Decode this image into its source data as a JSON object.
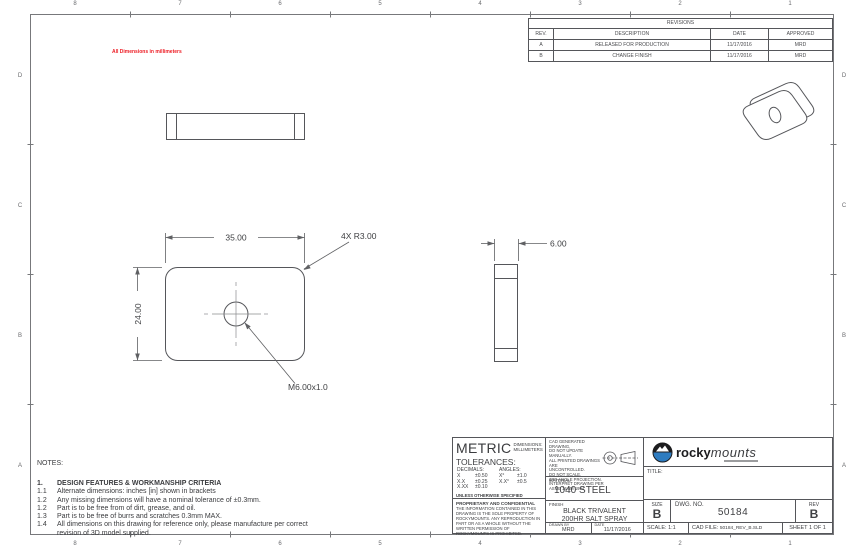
{
  "sheet": {
    "columns": [
      "8",
      "7",
      "6",
      "5",
      "4",
      "3",
      "2",
      "1"
    ],
    "rows": [
      "D",
      "C",
      "B",
      "A"
    ],
    "units_note": "All Dimensions in millimeters"
  },
  "revisions": {
    "title": "REVISIONS",
    "headers": [
      "REV.",
      "DESCRIPTION",
      "DATE",
      "APPROVED"
    ],
    "rows": [
      {
        "rev": "A",
        "description": "RELEASED FOR PRODUCTION",
        "date": "11/17/2016",
        "approved": "MRD"
      },
      {
        "rev": "B",
        "description": "CHANGE FINISH",
        "date": "11/17/2016",
        "approved": "MRD"
      }
    ]
  },
  "dims": {
    "width": "35.00",
    "height": "24.00",
    "corner_radius": "4X R3.00",
    "thickness": "6.00",
    "thread": "M6.00x1.0"
  },
  "notes": {
    "label": "NOTES:",
    "section_number": "1.",
    "section_title": "DESIGN FEATURES & WORKMANSHIP CRITERIA",
    "items": [
      {
        "num": "1.1",
        "text": "Alternate dimensions: inches [in] shown in brackets"
      },
      {
        "num": "1.2",
        "text": "Any missing dimensions will have a nominal tolerance of ±0.3mm."
      },
      {
        "num": "1.2",
        "text": "Part is to be free from of dirt, grease, and oil."
      },
      {
        "num": "1.3",
        "text": "Part is to be free of burrs and scratches 0.3mm MAX."
      },
      {
        "num": "1.4",
        "text": "All dimensions on this drawing for reference only, please manufacture per correct revision of 3D model supplied."
      }
    ]
  },
  "title_block": {
    "metric": {
      "title": "METRIC",
      "dims_label": "DIMENSIONS:",
      "dims_value": "MILLIMETERS"
    },
    "tolerances": {
      "label": "TOLERANCES:",
      "decimals_label": "DECIMALS:",
      "angles_label": "ANGLES:",
      "decimals_rows": [
        [
          "X",
          "±0.50"
        ],
        [
          "X.X",
          "±0.25"
        ],
        [
          "X.XX",
          "±0.10"
        ]
      ],
      "angles_rows": [
        [
          "X°",
          "±1.0"
        ],
        [
          "X.X°",
          "±0.5"
        ]
      ],
      "footnote": "UNLESS OTHERWISE SPECIFIED"
    },
    "proprietary": {
      "title": "PROPRIETARY AND CONFIDENTIAL",
      "body": "THE INFORMATION CONTAINED IN THIS DRAWING IS THE SOLE PROPERTY OF ROCKYMOUNTS. ANY REPRODUCTION IN PART OR AS A WHOLE WITHOUT THE WRITTEN PERMISSION OF ROCKYMOUNTS IS PROHIBITED."
    },
    "cad_note_lines": [
      "CAD GENERATED DRAWING,",
      "DO NOT UPDATE MANUALLY.",
      "ALL PRINTED DRAWINGS ARE",
      "UNCONTROLLED.",
      "DO NOT SCALE.",
      "3RD ANGLE PROJECTION.",
      "INTERPRET DRAWING PER",
      "ASME 14.5M 1994"
    ],
    "material": {
      "label": "MATERIAL",
      "value": "1040 STEEL"
    },
    "finish": {
      "label": "FINISH",
      "value_line1": "BLACK TRIVALENT",
      "value_line2": "200HR SALT SPRAY"
    },
    "drawn_by": {
      "label": "DRAWN BY",
      "value": "MRD"
    },
    "date": {
      "label": "DATE",
      "value": "11/17/2016"
    },
    "brand": {
      "name_bold": "rocky",
      "name_light": "mounts"
    },
    "title": {
      "label": "TITLE:",
      "value": ""
    },
    "size": {
      "label": "SIZE",
      "value": "B"
    },
    "dwg_no": {
      "label": "DWG.  NO.",
      "value": "50184"
    },
    "rev": {
      "label": "REV",
      "value": "B"
    },
    "scale": {
      "label": "SCALE: 1:1"
    },
    "cad_file": {
      "label": "CAD FILE:",
      "value": "50184_REV_B.SLD"
    },
    "sheet": {
      "label": "SHEET 1 OF 1"
    }
  },
  "colors": {
    "accent_red": "#ed1c24",
    "logo_blue": "#2e7cc0",
    "line_gray": "#55565a"
  }
}
